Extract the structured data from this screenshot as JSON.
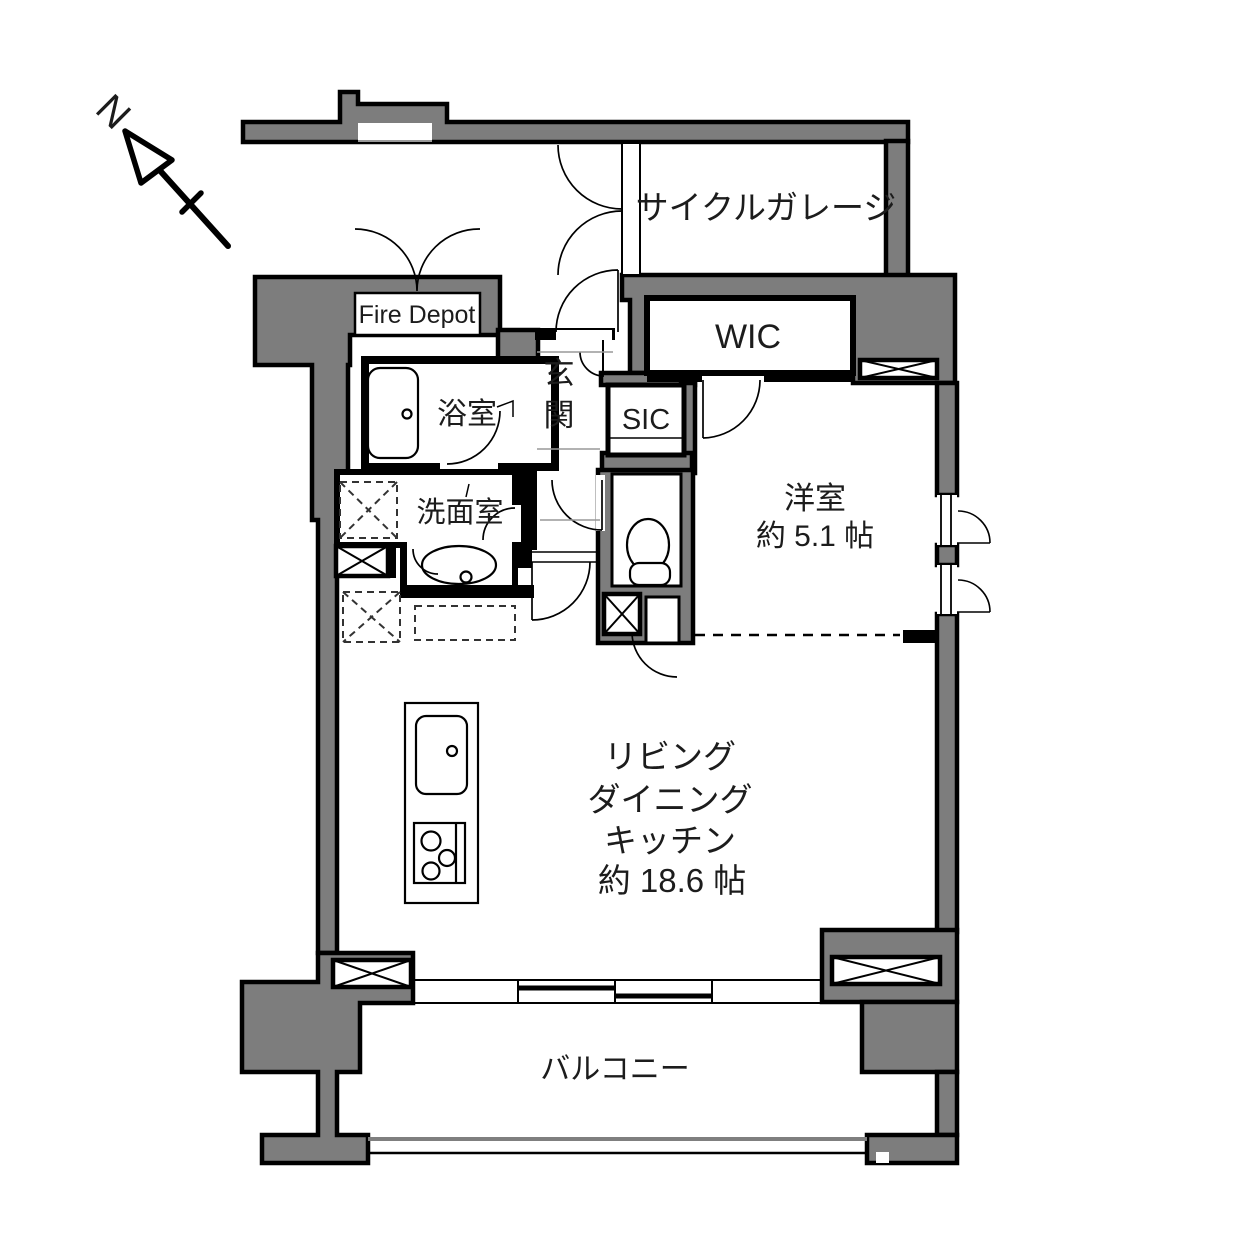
{
  "compass": {
    "north_label": "N"
  },
  "rooms": {
    "cycle_garage": {
      "label": "サイクルガレージ"
    },
    "fire_depot": {
      "label": "Fire Depot"
    },
    "wic": {
      "label": "WIC"
    },
    "sic": {
      "label": "SIC"
    },
    "entrance": {
      "label": "玄関",
      "chars": [
        "玄",
        "関"
      ]
    },
    "bathroom": {
      "label": "浴室"
    },
    "washroom": {
      "label": "洗面室"
    },
    "western_room": {
      "label": "洋室",
      "size": "約 5.1 帖"
    },
    "ldk": {
      "lines": [
        "リビング",
        "ダイニング",
        "キッチン",
        "約 18.6 帖"
      ]
    },
    "balcony": {
      "label": "バルコニー"
    }
  },
  "colors": {
    "wall": "#7d7d7d",
    "line": "#000000",
    "background": "#ffffff"
  }
}
